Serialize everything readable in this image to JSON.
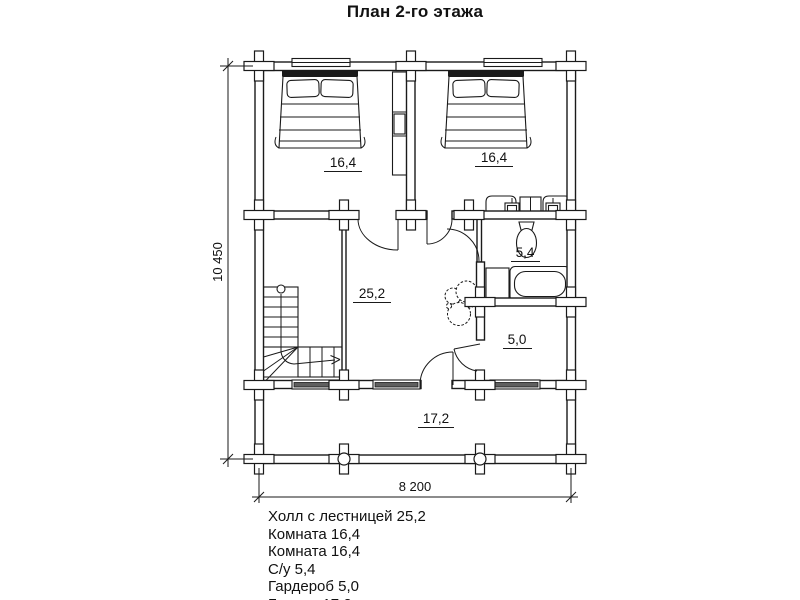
{
  "title": "План 2-го этажа",
  "plan": {
    "labels": {
      "bedroom1": "16,4",
      "bedroom2": "16,4",
      "hall": "25,2",
      "bathroom": "5,4",
      "wardrobe": "5,0",
      "balcony": "17,2"
    },
    "dimensions": {
      "height": "10 450",
      "width": "8 200"
    }
  },
  "legend": {
    "items": [
      "Холл с лестницей 25,2",
      "Комната 16,4",
      "Комната 16,4",
      "С/у 5,4",
      "Гардероб 5,0",
      "Балкон 17,2"
    ]
  },
  "colors": {
    "line": "#1a1a1a",
    "background": "#ffffff",
    "window_fill": "#5f5f5f"
  }
}
